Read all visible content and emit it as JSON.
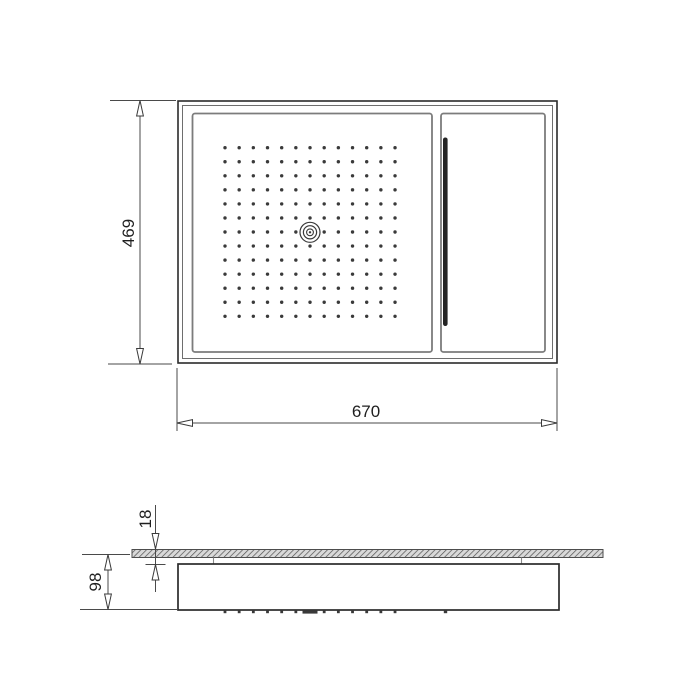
{
  "page": {
    "background": "#ffffff"
  },
  "style": {
    "ink": "#2b2b2b",
    "dim_line_color": "#4a4a4a",
    "text_color": "#1f1f1f",
    "panel_border": "#7c7c7c",
    "inner_frame_line": "#6e6e6e",
    "nozzle_color": "#3a3a3a",
    "waterfall_slot_color": "#242424",
    "hatch_background": "#d9d9d9",
    "hatch_line": "#4f4f4f"
  },
  "dimensions": {
    "overall_width": {
      "label": "670"
    },
    "overall_height": {
      "label": "469"
    },
    "ceiling_recess": {
      "label": "18"
    },
    "body_depth": {
      "label": "98"
    }
  },
  "top_view": {
    "nozzle_grid": {
      "cols": 13,
      "rows": 13,
      "start_x": 225,
      "start_y": 147.7,
      "dx": 14.17,
      "dy": 14.05,
      "radius": 1.7,
      "center_col": 6,
      "center_row": 6
    }
  },
  "side_view": {
    "nozzle_ticks": {
      "count": 13,
      "start_x": 225,
      "dx": 14.17,
      "y": 610.2,
      "width": 2.8,
      "height": 3,
      "skip_index": 6
    },
    "center_nozzle_tick": {
      "x": 310,
      "width": 15,
      "height": 3.4,
      "y": 610.2
    },
    "waterfall_tick": {
      "x": 445.5,
      "width": 3.4,
      "height": 3,
      "y": 610.2
    }
  }
}
